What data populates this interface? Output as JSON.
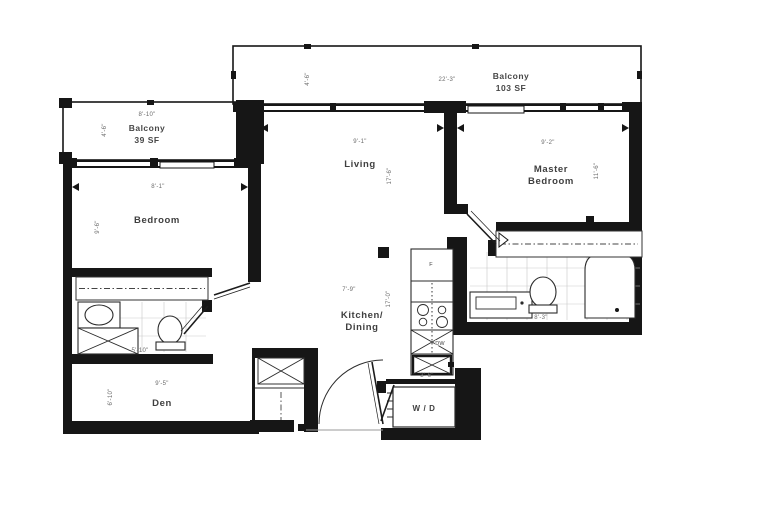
{
  "floor_plan": {
    "balcony_top": {
      "name": "Balcony",
      "area": "103 SF",
      "dim_w": "22'-3\"",
      "dim_d": "4'-6\""
    },
    "balcony_left": {
      "name": "Balcony",
      "area": "39 SF",
      "dim_w": "8'-10\"",
      "dim_d": "4'-6\""
    },
    "living": {
      "name": "Living",
      "dim_w": "9'-1\"",
      "dim_d": "17'-6\""
    },
    "master_bedroom": {
      "name1": "Master",
      "name2": "Bedroom",
      "dim_w": "9'-2\"",
      "dim_d": "11'-6\""
    },
    "bedroom": {
      "name": "Bedroom",
      "dim_w": "8'-1\"",
      "dim_d": "9'-6\""
    },
    "kitchen": {
      "name1": "Kitchen/",
      "name2": "Dining",
      "dim_w": "7'-9\"",
      "dim_d": "17'-0\""
    },
    "den": {
      "name": "Den",
      "dim_w": "9'-5\"",
      "dim_d": "6'-10\""
    },
    "master_bath": {
      "dim_w": "8'-3\""
    },
    "bath": {
      "dim_w": "5'-10\""
    },
    "laundry": {
      "name": "W / D",
      "dim_w": "3'-6\""
    },
    "appliances": {
      "dishwasher": "DW",
      "fridge": "F"
    }
  },
  "colors": {
    "wall": "#161616",
    "background": "#ffffff",
    "tile": "#c9c9c9",
    "label": "#3f3f3f",
    "dim": "#6b6b6b"
  }
}
